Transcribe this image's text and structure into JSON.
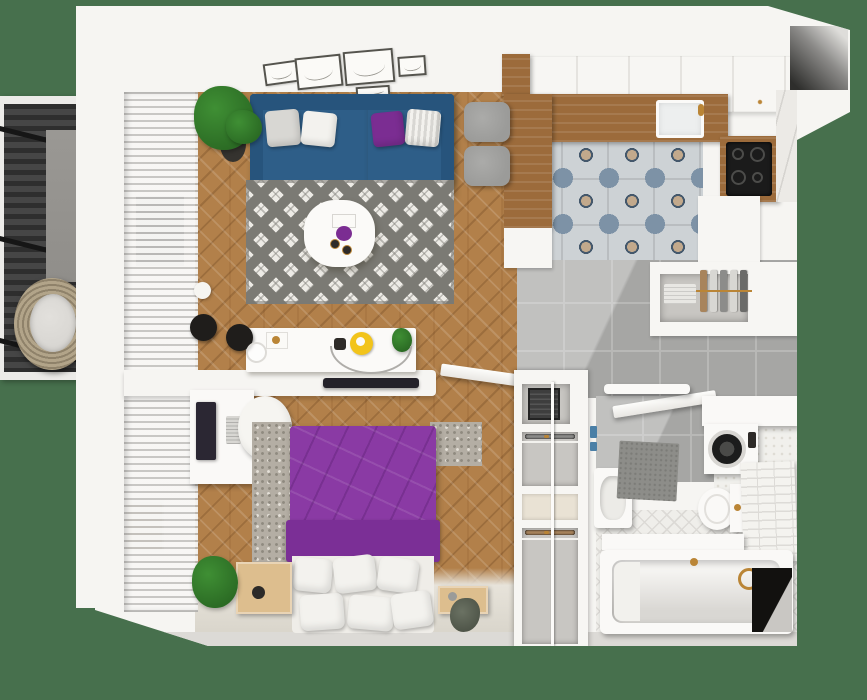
{
  "scene": {
    "title": "one-bedroom apartment 3D floor plan, top-down view",
    "canvas": {
      "width_px": 867,
      "height_px": 700
    }
  },
  "palette": {
    "background": "#47704D",
    "wall": "#F6F5F2",
    "wall_shadow": "#DCDAD6",
    "wood": "#B2804A",
    "counter_wood": "#9C6B3B",
    "entry_floor": "#E7E3DA",
    "window_glass": "#7F7F7D",
    "radiator": "#CFC5B2",
    "rug_base": "#EDEBE6",
    "rug_pattern": "#7B7A74",
    "sofa": "#2E5E88",
    "sofa_dark": "#27547C",
    "pillow_gray": "#D8D7D3",
    "pillow_white": "#F3F2EE",
    "accent_purple": "#7B2D92",
    "bed_purple": "#8A3AA4",
    "bed_purple_dark": "#7B2F96",
    "plant": "#3F8F34",
    "plant_dark": "#2B6B24",
    "pot": "#35332F",
    "table_white": "#FBFAF8",
    "tile_base": "#CDD2D5",
    "tile_blue": "#7D92A6",
    "tile_tan": "#C2A98C",
    "tile_navy": "#44586C",
    "tile_grout": "#B9BDC0",
    "gray_tile": "#A6A6A4",
    "gray_tile_grout": "#B8B8B6",
    "hex_floor": "#F1F0EC",
    "herring_tile": "#EFEEEA",
    "herring_line": "#DCDAD6",
    "marble": "#ECEAE6",
    "cabinet_seam": "#E5E3DF",
    "pantry_inner": "#C8C6C2",
    "plate_white": "#E8E7E3",
    "cooktop": "#1B1B1B",
    "burner": "#4C4C4A",
    "stool": "#9B9B99",
    "gold": "#BA8536",
    "safe": "#3E3E3E",
    "shoe_dark": "#2E2B28",
    "shoe_tan": "#A8845C",
    "shoe_gray": "#8C8C8A",
    "mat": "#8D8D89",
    "washer_door": "#1C1C1C",
    "towel_blue": "#4A7FA6",
    "black_corner": "#12110F",
    "deck": "#3E3E3E",
    "deck_dark": "#2E2E2E",
    "beam": "#161616",
    "concrete": "#908E8A",
    "rattan": "#B2A489",
    "rattan_dark": "#8F826A",
    "cushion": "#D8D6D2",
    "tv_dark": "#24222A",
    "monitor": "#2B2733",
    "yellow": "#F2C41B",
    "alcove_dark": "#2E2E2C",
    "art_line": "#98968F",
    "frame_border": "#55544E"
  },
  "wardrobe": {
    "upper_rows": 5,
    "lower_rows": 10,
    "shoe_palette": [
      "shoe_dark",
      "shoe_tan",
      "shoe_gray",
      "shoe_dark",
      "shoe_gray",
      "shoe_tan",
      "shoe_dark",
      "shoe_dark",
      "shoe_gray",
      "shoe_tan"
    ]
  },
  "rooms": [
    {
      "name": "balcony",
      "items": [
        {
          "name": "wood-decking"
        },
        {
          "name": "support-beam",
          "count": 3
        },
        {
          "name": "concrete-pillar"
        },
        {
          "name": "hanging-wicker-chair"
        }
      ]
    },
    {
      "name": "living-room",
      "items": [
        {
          "name": "vertical-blinds"
        },
        {
          "name": "window"
        },
        {
          "name": "radiator"
        },
        {
          "name": "blue-sofa"
        },
        {
          "name": "cushion",
          "count": 4
        },
        {
          "name": "geometric-rug"
        },
        {
          "name": "round-coffee-table"
        },
        {
          "name": "potted-palm"
        },
        {
          "name": "floor-lamp"
        },
        {
          "name": "tv-sideboard"
        },
        {
          "name": "gallery-frame",
          "count": 5
        },
        {
          "name": "wall-tv"
        }
      ]
    },
    {
      "name": "kitchen",
      "items": [
        {
          "name": "upper-cabinets"
        },
        {
          "name": "wood-counter-l"
        },
        {
          "name": "sink"
        },
        {
          "name": "cooktop"
        },
        {
          "name": "marble-backsplash"
        },
        {
          "name": "bar-stool",
          "count": 2
        },
        {
          "name": "patterned-tile-floor"
        },
        {
          "name": "dish-cabinet"
        },
        {
          "name": "plate-rack"
        }
      ]
    },
    {
      "name": "bedroom",
      "items": [
        {
          "name": "desk"
        },
        {
          "name": "monitor"
        },
        {
          "name": "keyboard"
        },
        {
          "name": "desk-chair"
        },
        {
          "name": "double-bed-purple"
        },
        {
          "name": "bed-pillow",
          "count": 6
        },
        {
          "name": "rug"
        },
        {
          "name": "nightstand",
          "count": 2
        },
        {
          "name": "plant",
          "count": 2
        }
      ]
    },
    {
      "name": "hallway",
      "items": [
        {
          "name": "gray-tile-floor"
        },
        {
          "name": "open-door",
          "count": 2
        },
        {
          "name": "shoe-wardrobe"
        },
        {
          "name": "safe-box"
        }
      ]
    },
    {
      "name": "bathroom",
      "items": [
        {
          "name": "wash-basin"
        },
        {
          "name": "washing-machine"
        },
        {
          "name": "toilet"
        },
        {
          "name": "bathtub"
        },
        {
          "name": "gold-faucet"
        },
        {
          "name": "bath-mat"
        },
        {
          "name": "tiled-half-wall"
        },
        {
          "name": "towel-shelf"
        },
        {
          "name": "leaning-mirror"
        }
      ]
    }
  ]
}
